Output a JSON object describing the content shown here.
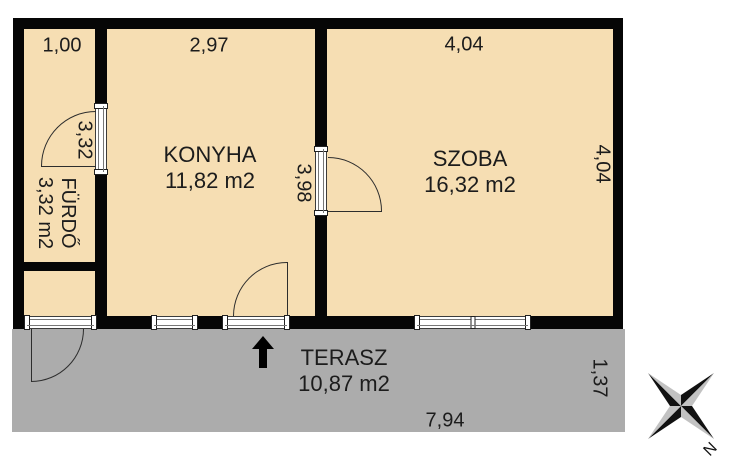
{
  "plan": {
    "title": "apartment floor plan",
    "rooms": [
      {
        "id": "furdo",
        "name": "FÜRDŐ",
        "area": "3,32 m2"
      },
      {
        "id": "konyha",
        "name": "KONYHA",
        "area": "11,82 m2"
      },
      {
        "id": "szoba",
        "name": "SZOBA",
        "area": "16,32 m2"
      },
      {
        "id": "terasz",
        "name": "TERASZ",
        "area": "10,87 m2"
      }
    ],
    "dims": {
      "furdo_width": "1,00",
      "konyha_width": "2,97",
      "szoba_width_top": "4,04",
      "furdo_length": "3,32",
      "konyha_length": "3,98",
      "szoba_length_right": "4,04",
      "terasz_depth": "1,37",
      "terasz_width": "7,94"
    },
    "compass": {
      "north": "N"
    },
    "colors": {
      "floor": "#F6DEB3",
      "terrace": "#ACACAC",
      "wall": "#060606"
    }
  }
}
